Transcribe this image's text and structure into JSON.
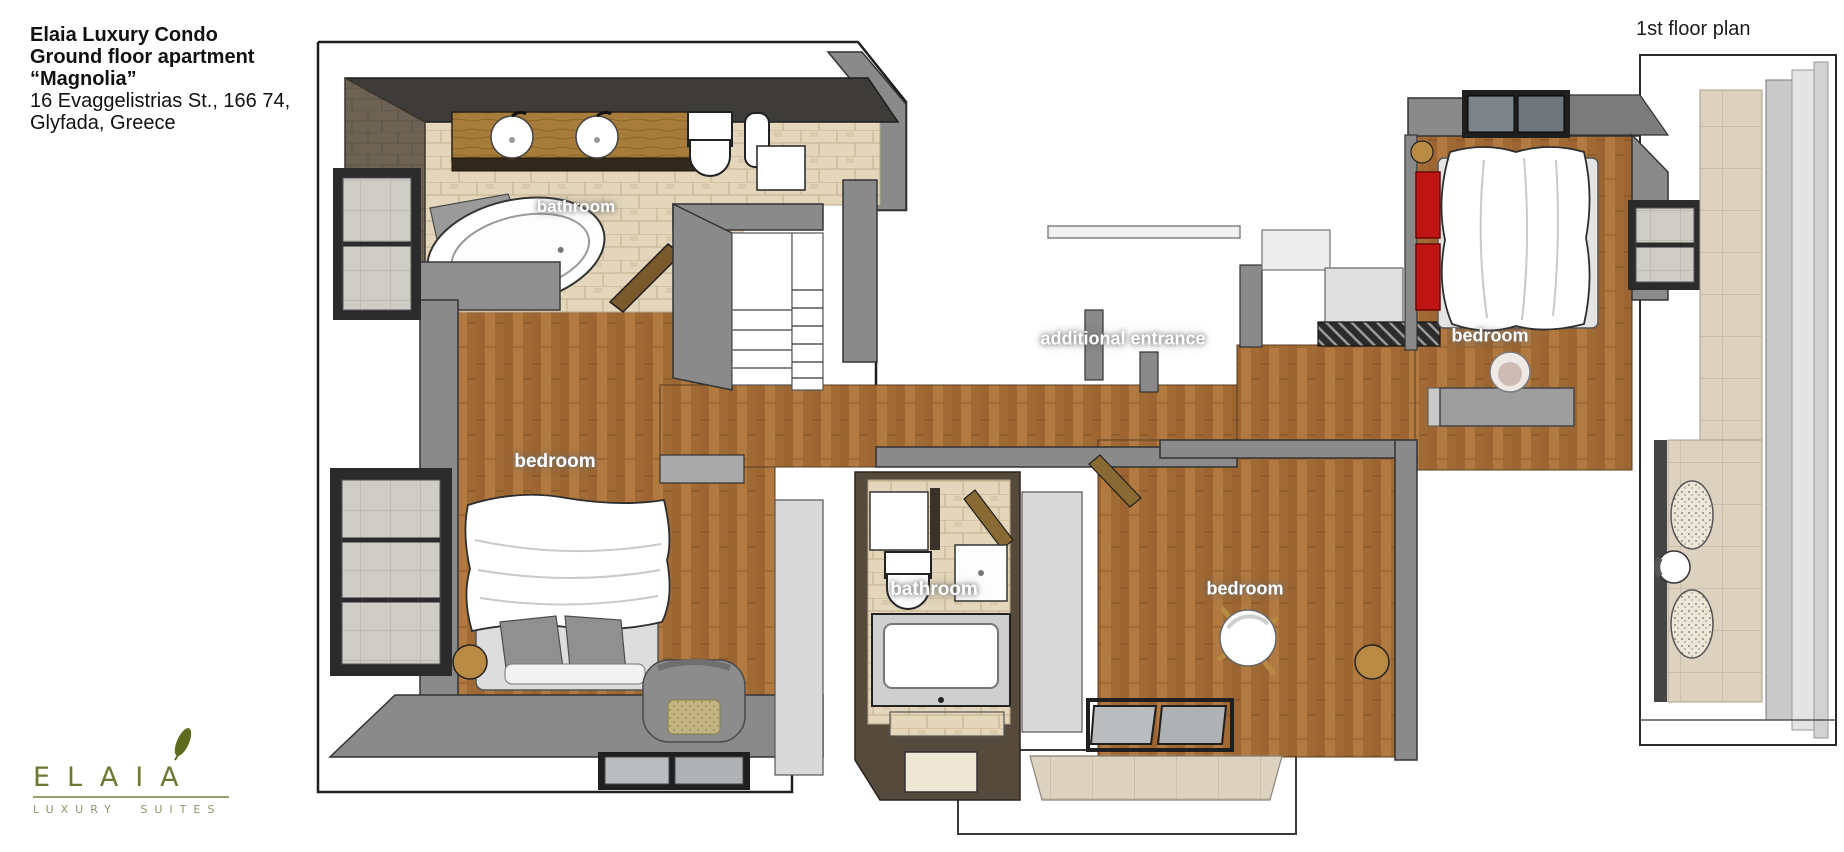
{
  "title_block": {
    "line1": "Elaia Luxury Condo",
    "line2": "Ground floor apartment",
    "line3": "“Magnolia”",
    "line4": "16 Evaggelistrias St., 166 74,",
    "line5": "Glyfada, Greece"
  },
  "plan_label": "1st floor plan",
  "room_labels": {
    "bathroom_top": "bathroom",
    "bedroom_left": "bedroom",
    "additional_entrance": "additional entrance",
    "bedroom_top_right": "bedroom",
    "bathroom_center": "bathroom",
    "bedroom_center": "bedroom"
  },
  "logo": {
    "name": "ELAIA",
    "tagline": "LUXURY SUITES",
    "leaf_icon": "olive-leaf-icon",
    "color_primary": "#6b7830",
    "color_tagline": "#8f946c"
  },
  "colors": {
    "wood_floor": "#a9713a",
    "wall_gray": "#8a8a8a",
    "wall_charcoal": "#3e3c39",
    "wall_brown_tile": "#6e6254",
    "tile_beige": "#e3d6ba",
    "tile_terrace": "#ddd2c0",
    "vanity_wood": "#a87c3a",
    "headboard_red": "#c01414"
  }
}
